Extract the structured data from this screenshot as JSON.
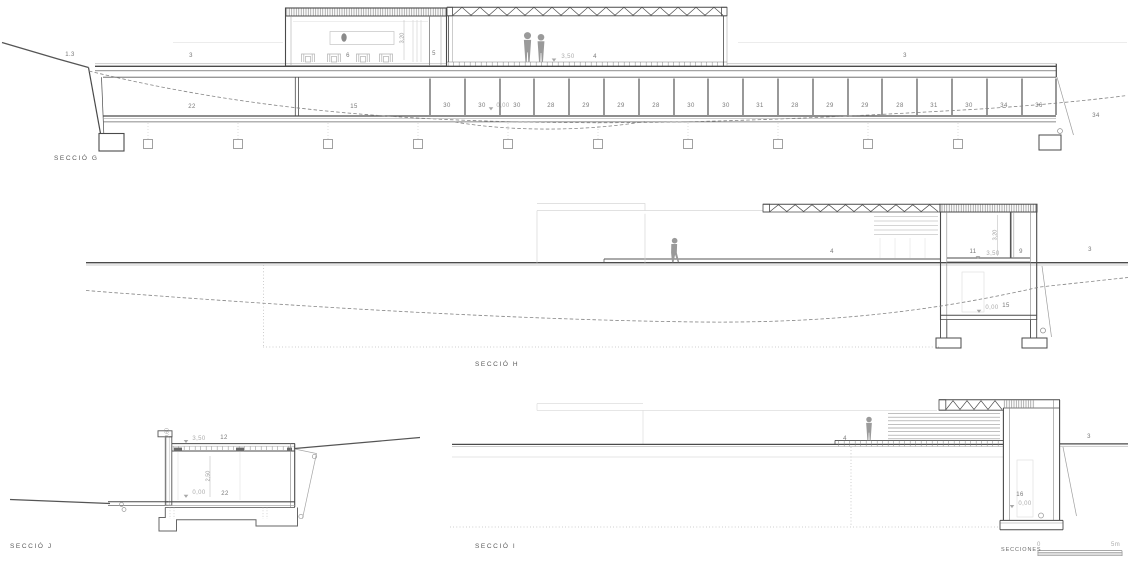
{
  "sheet": {
    "title": "SECCIONES",
    "scale_zero": "0",
    "scale_five": "5m"
  },
  "sections": {
    "g": {
      "name": "SECCIÓ G",
      "terrain_left": "1.3",
      "roof_left": "3",
      "roof_right": "3",
      "pavilion": "6",
      "pavilion_room": "5",
      "pavilion_height": "3,20",
      "hall": "4",
      "level_upper": "3,50",
      "level_ground": "0,00",
      "room_left": "22",
      "room_mid": "15",
      "terrain_right": "34",
      "bays": [
        "30",
        "30",
        "30",
        "28",
        "29",
        "29",
        "28",
        "30",
        "30",
        "31",
        "28",
        "29",
        "29",
        "28",
        "31",
        "30",
        "34",
        "36"
      ]
    },
    "h": {
      "name": "SECCIÓ H",
      "hall": "4",
      "room_upper": "11",
      "room_height": "3,20",
      "level_upper": "3,50",
      "room_side": "9",
      "ground_right": "3",
      "level_ground": "0,00",
      "room_lower": "15"
    },
    "j": {
      "name": "SECCIÓ J",
      "level_upper": "3,50",
      "roof": "12",
      "parapet_height": "0,60",
      "room_height": "2,50",
      "level_ground": "0,00",
      "room": "22"
    },
    "i": {
      "name": "SECCIÓ I",
      "deck": "4",
      "ground_right": "3",
      "shaft": "16",
      "level_ground": "0,00"
    }
  }
}
